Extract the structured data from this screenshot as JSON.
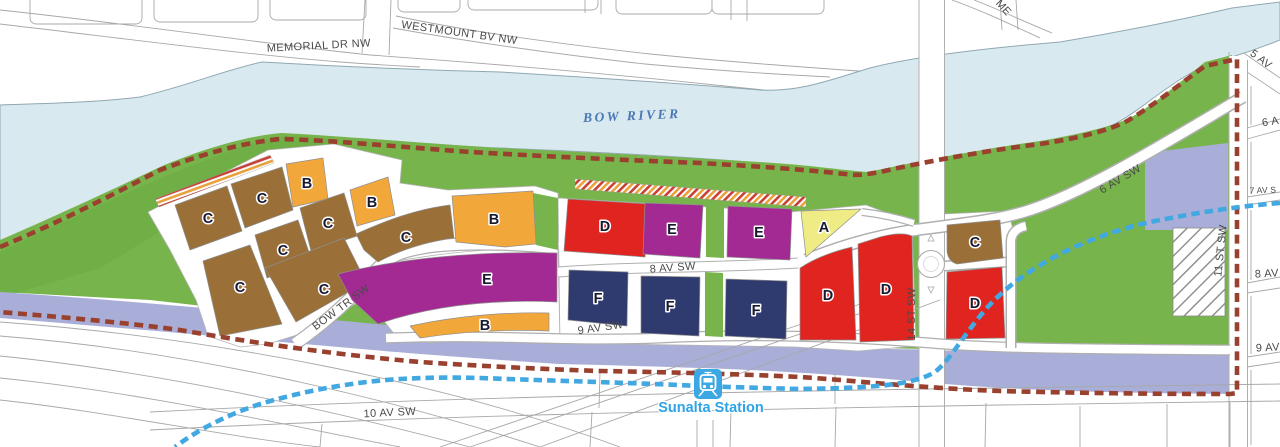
{
  "map": {
    "river": {
      "label": "BOW RIVER"
    },
    "station": {
      "label": "Sunalta Station",
      "icon": "train-icon"
    },
    "streets": {
      "memorial": "MEMORIAL DR NW",
      "westmount": "WESTMOUNT BV NW",
      "memorial_partial": "ME",
      "av5": "5 AV",
      "av6": "6 AV SW",
      "av6_partial": "6 A",
      "av7_partial": "7 AV S",
      "av8": "8 AV SW",
      "av8_partial": "8 AV",
      "av9": "9 AV SW",
      "av9_partial": "9 AV",
      "av10": "10 AV SW",
      "bow_trail": "BOW TR SW",
      "st14": "14 ST SW",
      "st11": "11 ST SW"
    },
    "parcels": {
      "letters": [
        "C",
        "C",
        "B",
        "B",
        "C",
        "C",
        "C",
        "C",
        "C",
        "B",
        "E",
        "B",
        "D",
        "E",
        "E",
        "A",
        "F",
        "F",
        "F",
        "D",
        "D",
        "C",
        "D"
      ],
      "zone_colors": {
        "A": "#EFEB85",
        "B": "#F2A73B",
        "C": "#9A7038",
        "D": "#E02520",
        "E": "#A32A92",
        "F": "#2F3A6E"
      }
    },
    "lines": {
      "plan_boundary_color": "#99412E",
      "lrt_color": "#41A8E1"
    },
    "base_colors": {
      "park_green": "#77B44C",
      "river_blue": "#D9E9F0",
      "rail_corridor": "#A9AED9"
    }
  }
}
